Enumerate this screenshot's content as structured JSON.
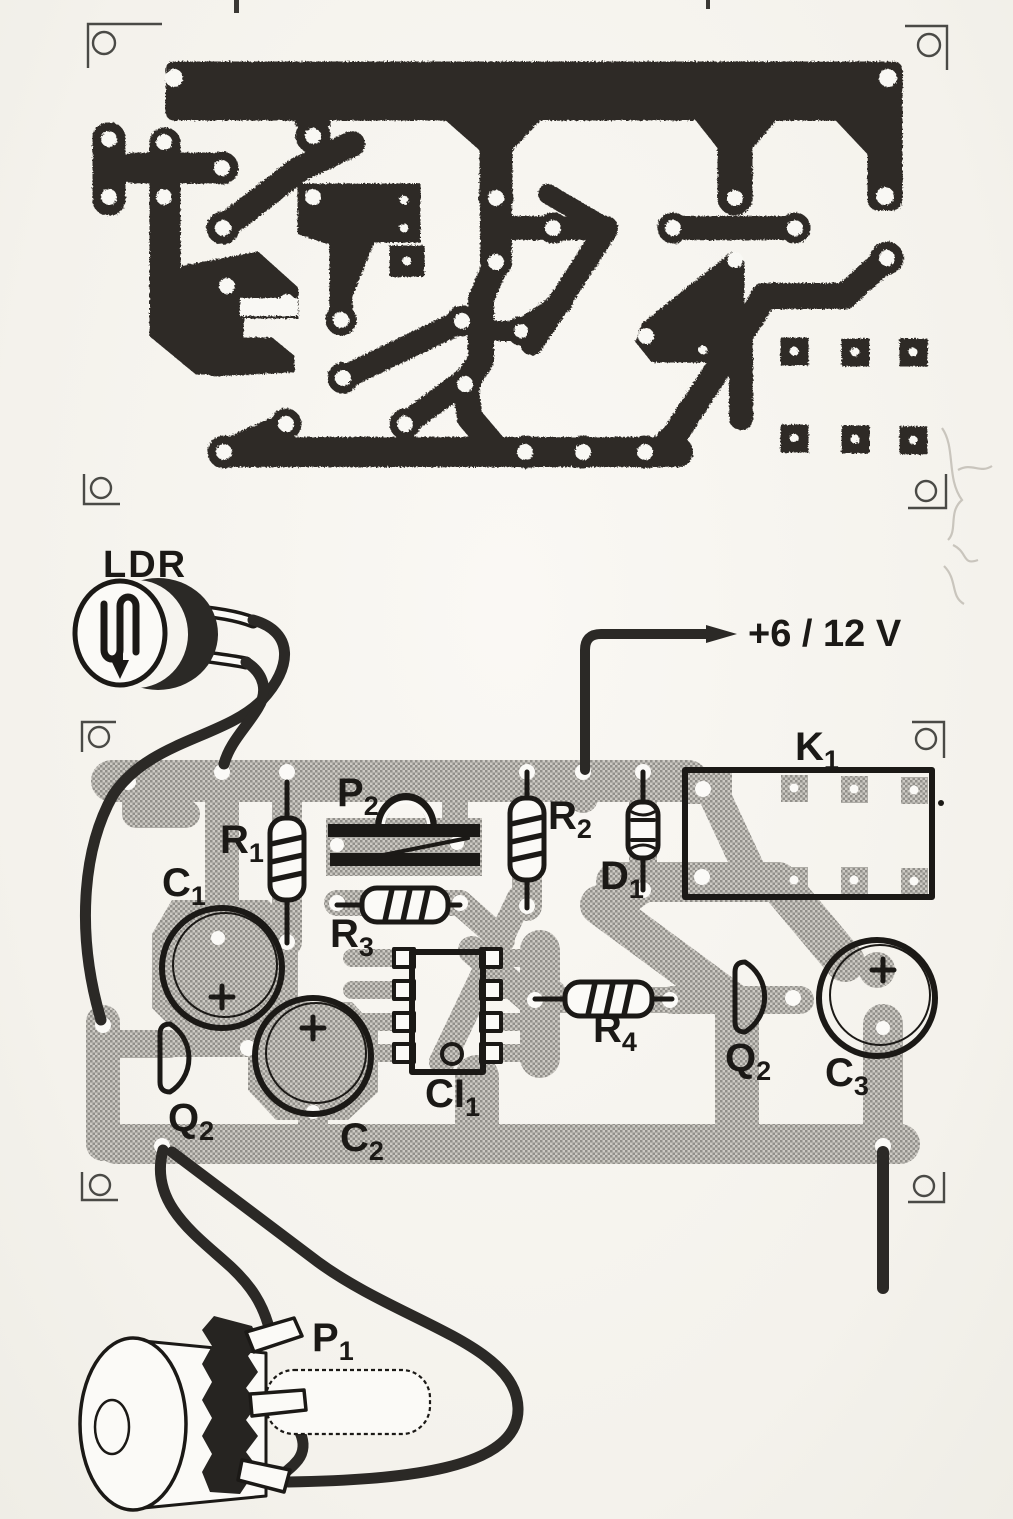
{
  "title": "PCB copper layout and component placement diagram",
  "colors": {
    "copper_trace": "#2e2b27",
    "component_trace_dark": "#918f8a",
    "component_trace_light": "#ccc9c3",
    "paper": "#f6f4ef",
    "ink": "#1b1916"
  },
  "labels": {
    "ldr": {
      "base": "LDR",
      "sub": ""
    },
    "supply": {
      "base": "+6 / 12 V",
      "sub": ""
    },
    "r1": {
      "base": "R",
      "sub": "1"
    },
    "p2": {
      "base": "P",
      "sub": "2"
    },
    "r2": {
      "base": "R",
      "sub": "2"
    },
    "d1": {
      "base": "D",
      "sub": "1"
    },
    "k1": {
      "base": "K",
      "sub": "1"
    },
    "c1": {
      "base": "C",
      "sub": "1"
    },
    "r3": {
      "base": "R",
      "sub": "3"
    },
    "ci1": {
      "base": "CI",
      "sub": "1"
    },
    "q2_left": {
      "base": "Q",
      "sub": "2"
    },
    "c2": {
      "base": "C",
      "sub": "2"
    },
    "r4": {
      "base": "R",
      "sub": "4"
    },
    "q2_right": {
      "base": "Q",
      "sub": "2"
    },
    "c3": {
      "base": "C",
      "sub": "3"
    },
    "p1": {
      "base": "P",
      "sub": "1"
    }
  }
}
